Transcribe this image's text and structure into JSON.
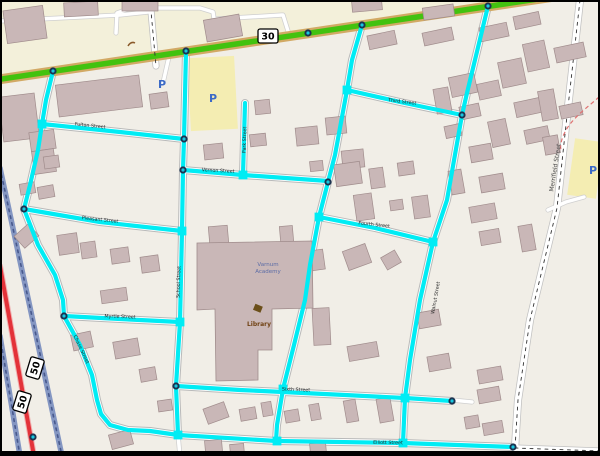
{
  "map": {
    "colors": {
      "land": "#f1eee7",
      "commercial": "#f3f0da",
      "building_fill": "#c9b7b7",
      "building_stroke": "#a08c8c",
      "school_fill": "#c9b7b7",
      "cyan": "#00ecf4",
      "road_casing": "#b9b9b9",
      "minor_casing": "#cfcfcf",
      "white_road": "#ffffff",
      "green_core": "#42c20f",
      "green_casing": "#d2a964",
      "red_road": "#e33239",
      "red_casing": "#f0b0b0",
      "ramp": "#8496c2",
      "ramp_dash": "#47588c",
      "dash_line": "#333333",
      "node_outer": "#1b3350",
      "node_inner": "#18c7e0",
      "parking_fill": "#f4edb2",
      "p_icon": "#3c6ac6",
      "label": "#2b2b2b",
      "merrifield_label": "#4a4a4a",
      "library_label": "#704214",
      "library_icon": "#6b4f1a",
      "school_label": "#5b6ca6",
      "red_dashed": "#e07070",
      "frame": "#000000",
      "squiggle": "#8a5a2a"
    },
    "green_road": [
      [
        -5,
        80
      ],
      [
        605,
        -11
      ]
    ],
    "green_nodes": [
      [
        53,
        71
      ],
      [
        186,
        51
      ],
      [
        308,
        33
      ],
      [
        362,
        25
      ],
      [
        488,
        6
      ]
    ],
    "commercial_poly": [
      [
        0,
        0
      ],
      [
        540,
        0
      ],
      [
        0,
        80
      ]
    ],
    "interstate": {
      "ramps": [
        [
          [
            0,
            336
          ],
          [
            20,
            456
          ]
        ],
        [
          [
            0,
            168
          ],
          [
            62,
            456
          ]
        ]
      ],
      "red": [
        [
          0,
          266
        ],
        [
          34,
          456
        ]
      ],
      "ramp_node": [
        33,
        437
      ]
    },
    "merrifield": [
      [
        580,
        0
      ],
      [
        566,
        125
      ],
      [
        557,
        208
      ],
      [
        530,
        320
      ],
      [
        518,
        400
      ],
      [
        515,
        448
      ]
    ],
    "dashed_roads": [
      [
        [
          150,
          0
        ],
        [
          156,
          66
        ]
      ],
      [
        [
          515,
          448
        ],
        [
          600,
          451
        ]
      ]
    ],
    "minor_roads": [
      [
        [
          0,
          21
        ],
        [
          120,
          15
        ],
        [
          148,
          12
        ]
      ],
      [
        [
          116,
          33
        ],
        [
          117,
          13
        ],
        [
          131,
          8
        ],
        [
          200,
          8
        ],
        [
          213,
          12
        ],
        [
          216,
          31
        ]
      ],
      [
        [
          216,
          19
        ],
        [
          282,
          15
        ]
      ],
      [
        [
          283,
          15
        ],
        [
          288,
          31
        ]
      ],
      [
        [
          170,
          52
        ],
        [
          163,
          83
        ]
      ],
      [
        [
          548,
          210
        ],
        [
          566,
          202
        ],
        [
          584,
          197
        ]
      ],
      [
        [
          178,
          435
        ],
        [
          180,
          456
        ]
      ],
      [
        [
          452,
          400
        ],
        [
          472,
          402
        ]
      ]
    ],
    "routes": [
      {
        "name": "chase-street",
        "pts": [
          [
            53,
            71
          ],
          [
            46,
            100
          ],
          [
            42,
            124
          ],
          [
            38,
            150
          ],
          [
            30,
            185
          ],
          [
            24,
            209
          ],
          [
            38,
            245
          ],
          [
            55,
            275
          ],
          [
            63,
            300
          ],
          [
            64,
            316
          ],
          [
            80,
            345
          ],
          [
            92,
            375
          ],
          [
            97,
            400
          ],
          [
            101,
            414
          ],
          [
            110,
            425
          ],
          [
            128,
            430
          ],
          [
            150,
            431
          ]
        ]
      },
      {
        "name": "fulton-street",
        "pts": [
          [
            42,
            124
          ],
          [
            120,
            132
          ],
          [
            184,
            139
          ]
        ]
      },
      {
        "name": "pleasant-street",
        "pts": [
          [
            24,
            209
          ],
          [
            100,
            222
          ],
          [
            182,
            231
          ]
        ]
      },
      {
        "name": "school-street",
        "pts": [
          [
            186,
            51
          ],
          [
            184,
            139
          ],
          [
            183,
            170
          ],
          [
            182,
            231
          ],
          [
            180,
            322
          ],
          [
            176,
            386
          ],
          [
            178,
            435
          ]
        ]
      },
      {
        "name": "vernon-street",
        "pts": [
          [
            183,
            170
          ],
          [
            243,
            175
          ],
          [
            328,
            181
          ]
        ]
      },
      {
        "name": "park-street",
        "pts": [
          [
            245,
            103
          ],
          [
            243,
            175
          ]
        ]
      },
      {
        "name": "diagonal-street",
        "pts": [
          [
            362,
            25
          ],
          [
            352,
            60
          ],
          [
            347,
            90
          ],
          [
            335,
            155
          ],
          [
            328,
            182
          ],
          [
            319,
            217
          ],
          [
            310,
            265
          ],
          [
            305,
            300
          ],
          [
            294,
            345
          ],
          [
            283,
            389
          ],
          [
            277,
            425
          ],
          [
            276,
            441
          ]
        ]
      },
      {
        "name": "third-street",
        "pts": [
          [
            347,
            90
          ],
          [
            400,
            102
          ],
          [
            462,
            115
          ]
        ]
      },
      {
        "name": "fourth-street",
        "pts": [
          [
            319,
            217
          ],
          [
            375,
            228
          ],
          [
            433,
            242
          ]
        ]
      },
      {
        "name": "walnut-street",
        "pts": [
          [
            488,
            6
          ],
          [
            467,
            93
          ],
          [
            462,
            115
          ],
          [
            447,
            200
          ],
          [
            433,
            242
          ],
          [
            420,
            300
          ],
          [
            410,
            360
          ],
          [
            405,
            398
          ],
          [
            403,
            443
          ]
        ]
      },
      {
        "name": "sixth-street",
        "pts": [
          [
            176,
            386
          ],
          [
            240,
            390
          ],
          [
            283,
            392
          ],
          [
            345,
            395
          ],
          [
            405,
            398
          ],
          [
            452,
            401
          ]
        ]
      },
      {
        "name": "elliott-street",
        "pts": [
          [
            150,
            431
          ],
          [
            178,
            435
          ],
          [
            277,
            441
          ],
          [
            403,
            443
          ],
          [
            513,
            447
          ]
        ]
      },
      {
        "name": "myrtle-street",
        "pts": [
          [
            64,
            316
          ],
          [
            120,
            319
          ],
          [
            180,
            322
          ]
        ]
      }
    ],
    "junction_squares": [
      [
        42,
        124
      ],
      [
        182,
        231
      ],
      [
        180,
        322
      ],
      [
        178,
        435
      ],
      [
        243,
        175
      ],
      [
        319,
        217
      ],
      [
        347,
        90
      ],
      [
        283,
        389
      ],
      [
        433,
        242
      ],
      [
        405,
        398
      ],
      [
        403,
        443
      ],
      [
        277,
        441
      ]
    ],
    "nodes": [
      [
        53,
        71
      ],
      [
        186,
        51
      ],
      [
        308,
        33
      ],
      [
        362,
        25
      ],
      [
        488,
        6
      ],
      [
        24,
        209
      ],
      [
        64,
        316
      ],
      [
        184,
        139
      ],
      [
        183,
        170
      ],
      [
        176,
        386
      ],
      [
        328,
        182
      ],
      [
        462,
        115
      ],
      [
        513,
        447
      ],
      [
        452,
        401
      ]
    ],
    "buildings": [
      [
        5,
        8,
        40,
        33,
        -8
      ],
      [
        64,
        2,
        34,
        14,
        -3
      ],
      [
        122,
        0,
        36,
        11,
        0
      ],
      [
        205,
        17,
        36,
        22,
        -10
      ],
      [
        352,
        0,
        30,
        11,
        -5
      ],
      [
        423,
        6,
        31,
        12,
        -8
      ],
      [
        1,
        95,
        36,
        45,
        -7
      ],
      [
        30,
        131,
        25,
        19,
        -8
      ],
      [
        57,
        80,
        84,
        32,
        -7
      ],
      [
        150,
        93,
        18,
        15,
        -8
      ],
      [
        33,
        150,
        22,
        23,
        -8
      ],
      [
        20,
        183,
        15,
        11,
        -10
      ],
      [
        38,
        186,
        16,
        12,
        -10
      ],
      [
        44,
        156,
        15,
        12,
        -8
      ],
      [
        17,
        228,
        19,
        16,
        -42
      ],
      [
        58,
        234,
        20,
        20,
        -8
      ],
      [
        81,
        242,
        15,
        16,
        -8
      ],
      [
        111,
        248,
        18,
        15,
        -8
      ],
      [
        141,
        256,
        18,
        16,
        -8
      ],
      [
        101,
        289,
        26,
        13,
        -8
      ],
      [
        72,
        333,
        20,
        16,
        -12
      ],
      [
        114,
        340,
        25,
        17,
        -10
      ],
      [
        140,
        368,
        16,
        13,
        -10
      ],
      [
        204,
        144,
        19,
        15,
        -6
      ],
      [
        250,
        134,
        16,
        12,
        -6
      ],
      [
        296,
        127,
        22,
        18,
        -6
      ],
      [
        326,
        117,
        20,
        17,
        -6
      ],
      [
        342,
        150,
        22,
        18,
        -6
      ],
      [
        310,
        161,
        13,
        10,
        -6
      ],
      [
        255,
        100,
        15,
        14,
        -6
      ],
      [
        209,
        226,
        19,
        18,
        -5
      ],
      [
        280,
        226,
        13,
        16,
        -5
      ],
      [
        335,
        163,
        26,
        22,
        -8
      ],
      [
        370,
        168,
        14,
        20,
        -8
      ],
      [
        398,
        162,
        16,
        13,
        -8
      ],
      [
        355,
        194,
        18,
        26,
        -8
      ],
      [
        390,
        200,
        13,
        10,
        -8
      ],
      [
        413,
        196,
        16,
        22,
        -8
      ],
      [
        345,
        247,
        24,
        20,
        -20
      ],
      [
        310,
        250,
        14,
        20,
        -8
      ],
      [
        383,
        253,
        16,
        14,
        -30
      ],
      [
        313,
        308,
        17,
        37,
        -3
      ],
      [
        348,
        344,
        30,
        15,
        -10
      ],
      [
        368,
        33,
        28,
        14,
        -12
      ],
      [
        423,
        30,
        30,
        13,
        -12
      ],
      [
        480,
        25,
        28,
        14,
        -12
      ],
      [
        514,
        14,
        26,
        13,
        -12
      ],
      [
        525,
        42,
        22,
        28,
        -12
      ],
      [
        555,
        45,
        30,
        15,
        -12
      ],
      [
        500,
        60,
        24,
        26,
        -12
      ],
      [
        450,
        75,
        26,
        20,
        -12
      ],
      [
        460,
        105,
        20,
        13,
        -12
      ],
      [
        515,
        100,
        26,
        15,
        -12
      ],
      [
        560,
        104,
        22,
        13,
        -12
      ],
      [
        490,
        120,
        18,
        26,
        -12
      ],
      [
        525,
        128,
        24,
        14,
        -12
      ],
      [
        445,
        125,
        16,
        12,
        -12
      ],
      [
        478,
        82,
        22,
        16,
        -12
      ],
      [
        435,
        88,
        15,
        25,
        -10
      ],
      [
        540,
        90,
        16,
        30,
        -10
      ],
      [
        470,
        145,
        22,
        16,
        -10
      ],
      [
        450,
        170,
        13,
        24,
        -10
      ],
      [
        480,
        175,
        24,
        16,
        -10
      ],
      [
        544,
        136,
        15,
        18,
        -10
      ],
      [
        470,
        205,
        26,
        16,
        -10
      ],
      [
        480,
        230,
        20,
        14,
        -10
      ],
      [
        520,
        225,
        14,
        26,
        -10
      ],
      [
        418,
        311,
        22,
        16,
        -10
      ],
      [
        428,
        355,
        22,
        15,
        -10
      ],
      [
        478,
        368,
        24,
        14,
        -10
      ],
      [
        478,
        388,
        22,
        14,
        -10
      ],
      [
        465,
        416,
        14,
        12,
        -10
      ],
      [
        483,
        422,
        20,
        12,
        -10
      ],
      [
        158,
        400,
        14,
        11,
        -8
      ],
      [
        205,
        405,
        22,
        16,
        -20
      ],
      [
        240,
        408,
        16,
        12,
        -10
      ],
      [
        262,
        402,
        10,
        14,
        -10
      ],
      [
        285,
        410,
        14,
        12,
        -10
      ],
      [
        310,
        404,
        10,
        16,
        -10
      ],
      [
        345,
        400,
        12,
        22,
        -10
      ],
      [
        378,
        398,
        14,
        24,
        -10
      ],
      [
        110,
        432,
        22,
        15,
        -15
      ],
      [
        205,
        440,
        17,
        12,
        -5
      ],
      [
        230,
        444,
        14,
        10,
        -5
      ],
      [
        310,
        443,
        16,
        10,
        -5
      ]
    ],
    "school_poly": [
      [
        197,
        243
      ],
      [
        312,
        241
      ],
      [
        313,
        308
      ],
      [
        272,
        309
      ],
      [
        272,
        350
      ],
      [
        258,
        350
      ],
      [
        258,
        380
      ],
      [
        216,
        381
      ],
      [
        215,
        309
      ],
      [
        197,
        310
      ]
    ],
    "parking_areas": [
      {
        "x": 189,
        "y": 57,
        "w": 47,
        "h": 73,
        "rot": -3
      },
      {
        "x": 571,
        "y": 140,
        "w": 29,
        "h": 57,
        "rot": 8
      }
    ],
    "parking_icons": [
      {
        "label": "P",
        "x": 162,
        "y": 88
      },
      {
        "label": "P",
        "x": 213,
        "y": 102
      },
      {
        "label": "P",
        "x": 593,
        "y": 174
      }
    ],
    "shields": [
      {
        "text": "30",
        "x": 268,
        "y": 36,
        "rot": 0
      },
      {
        "text": "50",
        "x": 35,
        "y": 368,
        "rot": -73
      },
      {
        "text": "50",
        "x": 22,
        "y": 402,
        "rot": -73
      }
    ],
    "street_labels": [
      {
        "text": "Fulton Street",
        "x": 90,
        "y": 127,
        "rot": 6
      },
      {
        "text": "Park Street",
        "x": 246,
        "y": 140,
        "rot": -88
      },
      {
        "text": "Vernon Street",
        "x": 218,
        "y": 172,
        "rot": 3
      },
      {
        "text": "Pleasant Street",
        "x": 100,
        "y": 221,
        "rot": 6
      },
      {
        "text": "School Street",
        "x": 180,
        "y": 282,
        "rot": -88
      },
      {
        "text": "Myrtle Street",
        "x": 120,
        "y": 318,
        "rot": 2
      },
      {
        "text": "Chase Street",
        "x": 80,
        "y": 350,
        "rot": 65
      },
      {
        "text": "Third Street",
        "x": 402,
        "y": 103,
        "rot": 7
      },
      {
        "text": "Fourth Street",
        "x": 374,
        "y": 226,
        "rot": 6
      },
      {
        "text": "Walnut Street",
        "x": 437,
        "y": 298,
        "rot": -80
      },
      {
        "text": "Sixth Street",
        "x": 296,
        "y": 391,
        "rot": 2
      },
      {
        "text": "Elliott Street",
        "x": 388,
        "y": 444,
        "rot": 1
      },
      {
        "text": "Merrifield Street",
        "x": 557,
        "y": 168,
        "rot": -81
      }
    ],
    "pois": {
      "library": {
        "label": "Library",
        "x": 259,
        "y": 326,
        "icon_x": 258,
        "icon_y": 308
      },
      "school": {
        "line1": "Varnum",
        "line2": "Academy",
        "x": 268,
        "y": 266
      }
    },
    "red_dashed_path": "M599,97 C588,107 572,118 565,132 C561,140 560,146 561,150",
    "squiggle_path": "M128,46 q3,-5 7,-3",
    "frame": {
      "top": 2,
      "left": 2,
      "right": 2,
      "bottom": 5
    }
  }
}
